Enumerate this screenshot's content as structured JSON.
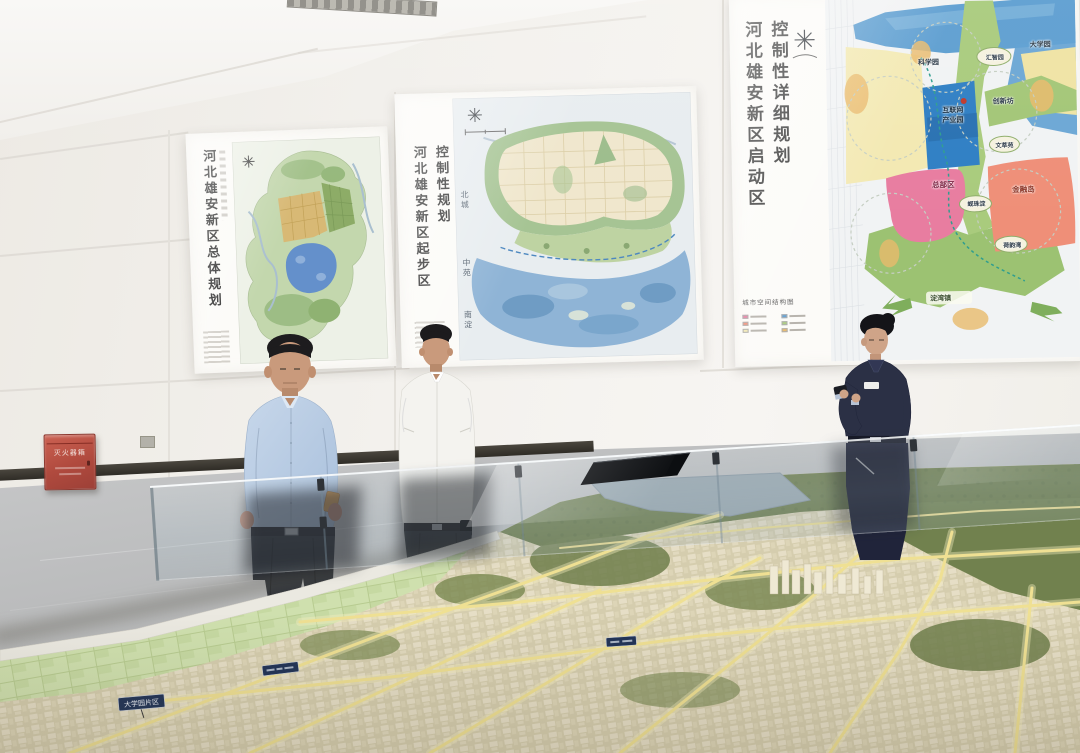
{
  "colors": {
    "wall": "#f2f0eb",
    "floor": "#b7b8b9",
    "poster_paper": "#fcfbf8",
    "fire_box_red": "#b04a3e",
    "map_water_blue": "#5d9ed1",
    "zone_pink": "#e87da0",
    "zone_salmon": "#ef8f78",
    "zone_green": "#a9cb7d",
    "zone_yellow": "#f3e9b2",
    "internet_blue": "#2f7fc4",
    "model_base": "#d9d1b3",
    "model_road_glow": "#efe093",
    "model_sign_navy": "#223457",
    "uniform_navy": "#2c3146",
    "shirt_blue": "#bcd0e8"
  },
  "posters": {
    "left": {
      "title": "河北雄安新区总体规划"
    },
    "middle": {
      "title_main": "控制性规划",
      "title_sub": "河北雄安新区起步区",
      "label_north": "北城",
      "label_middle": "中苑",
      "label_south": "南淀"
    },
    "right": {
      "title_main": "控制性详细规划",
      "title_sub": "河北雄安新区启动区",
      "caption": "城市空间结构图",
      "zones": {
        "science_park": "科学园",
        "huizhi_park": "汇智园",
        "university_park": "大学园",
        "innovation_block": "创新坊",
        "internet_line1": "互联网",
        "internet_line2": "产业园",
        "wencui_park": "文萃苑",
        "headquarters": "总部区",
        "xianzhu_lake": "蚬珠淀",
        "finance_island": "金融岛",
        "heyun_bay": "荷韵湾",
        "dianwan_town": "淀湾镇"
      }
    }
  },
  "equipment": {
    "fire_box_label": "灭火器箱"
  },
  "model": {
    "sign_1": "大学园片区"
  }
}
